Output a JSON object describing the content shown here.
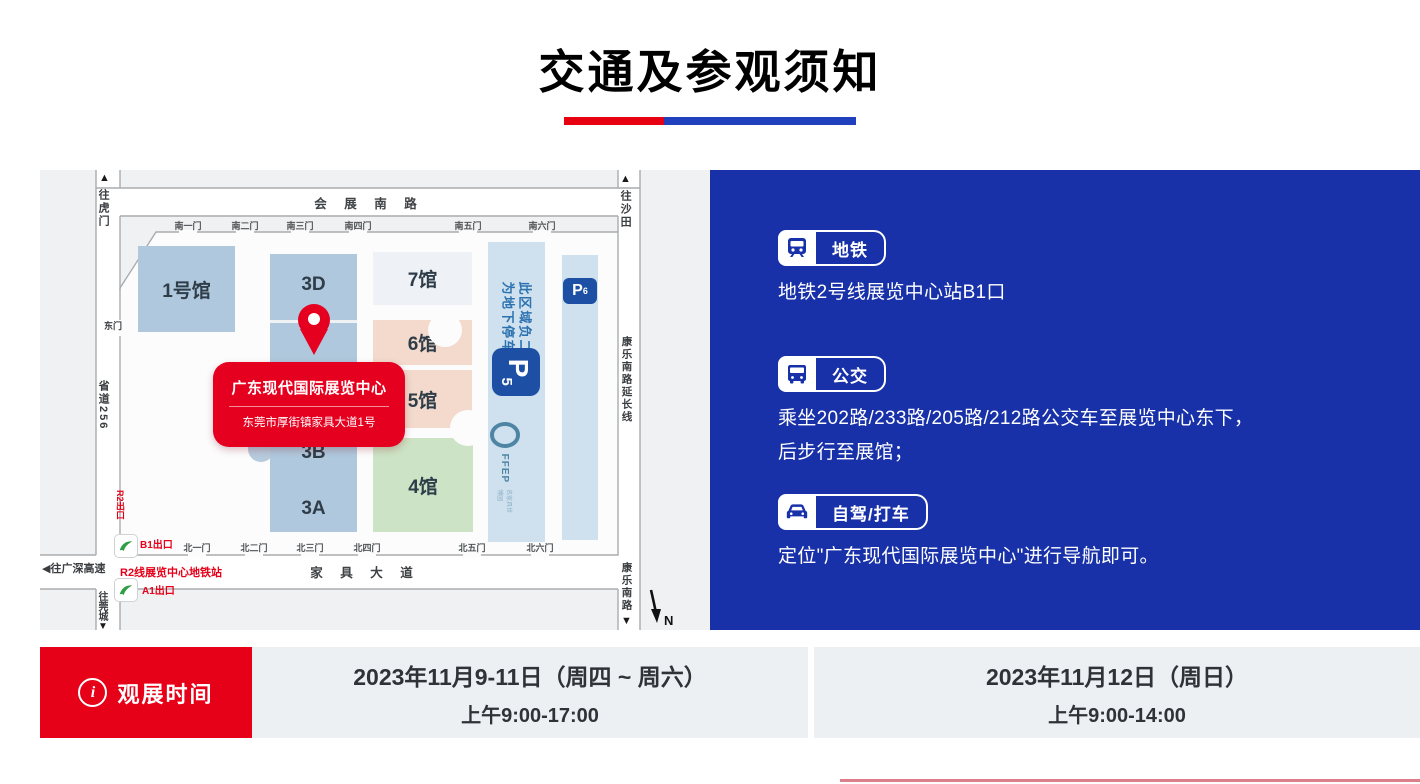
{
  "title": "交通及参观须知",
  "colors": {
    "red": "#e60018",
    "blue": "#1831a8"
  },
  "map": {
    "directions": {
      "humen": "往虎门",
      "shatian": "往沙田",
      "guancheng": "往莞城",
      "guanshen": "往广深高速",
      "arrow_up": "▲",
      "arrow_down": "▼",
      "arrow_left": "◀"
    },
    "roads": {
      "exhibition_south": "会 展 南 路",
      "furniture_ave": "家 具 大 道",
      "provincial": "省道256",
      "kangle_ext": "康乐南路延长线",
      "kangle": "康乐南路"
    },
    "gates_south": [
      "南一门",
      "南二门",
      "南三门",
      "南四门",
      "南五门",
      "南六门"
    ],
    "gates_north": [
      "北一门",
      "北二门",
      "北三门",
      "北四门",
      "北五门",
      "北六门"
    ],
    "gate_east": "东门",
    "halls": {
      "h1": "1号馆",
      "h3d": "3D",
      "h3b": "3B",
      "h3a": "3A",
      "h7": "7馆",
      "h6": "6馆",
      "h5": "5馆",
      "h4": "4馆"
    },
    "parking": {
      "note_line1": "此区域负二层",
      "note_line2": "为地下停车场",
      "p": "P",
      "p5_sub": "5",
      "p6_sub": "6"
    },
    "ffep": {
      "logo": "FFEP",
      "name": "名家具世博园"
    },
    "metro": {
      "station": "R2线展览中心地铁站",
      "exit_b1": "B1出口",
      "exit_a1": "A1出口",
      "exit_r2": "R2出口"
    },
    "callout": {
      "title": "广东现代国际展览中心",
      "address": "东莞市厚街镇家具大道1号"
    },
    "compass": "N"
  },
  "transport": {
    "items": [
      {
        "label": "地铁",
        "lines": [
          "地铁2号线展览中心站B1口"
        ]
      },
      {
        "label": "公交",
        "lines": [
          "乘坐202路/233路/205路/212路公交车至展览中心东下，",
          "后步行至展馆；"
        ]
      },
      {
        "label": "自驾/打车",
        "lines": [
          "定位\"广东现代国际展览中心\"进行导航即可。"
        ]
      }
    ]
  },
  "schedule": {
    "label": "观展时间",
    "icon": "i",
    "sessions": [
      {
        "date": "2023年11月9-11日（周四 ~ 周六）",
        "time": "上午9:00-17:00"
      },
      {
        "date": "2023年11月12日（周日）",
        "time": "上午9:00-14:00"
      }
    ]
  }
}
